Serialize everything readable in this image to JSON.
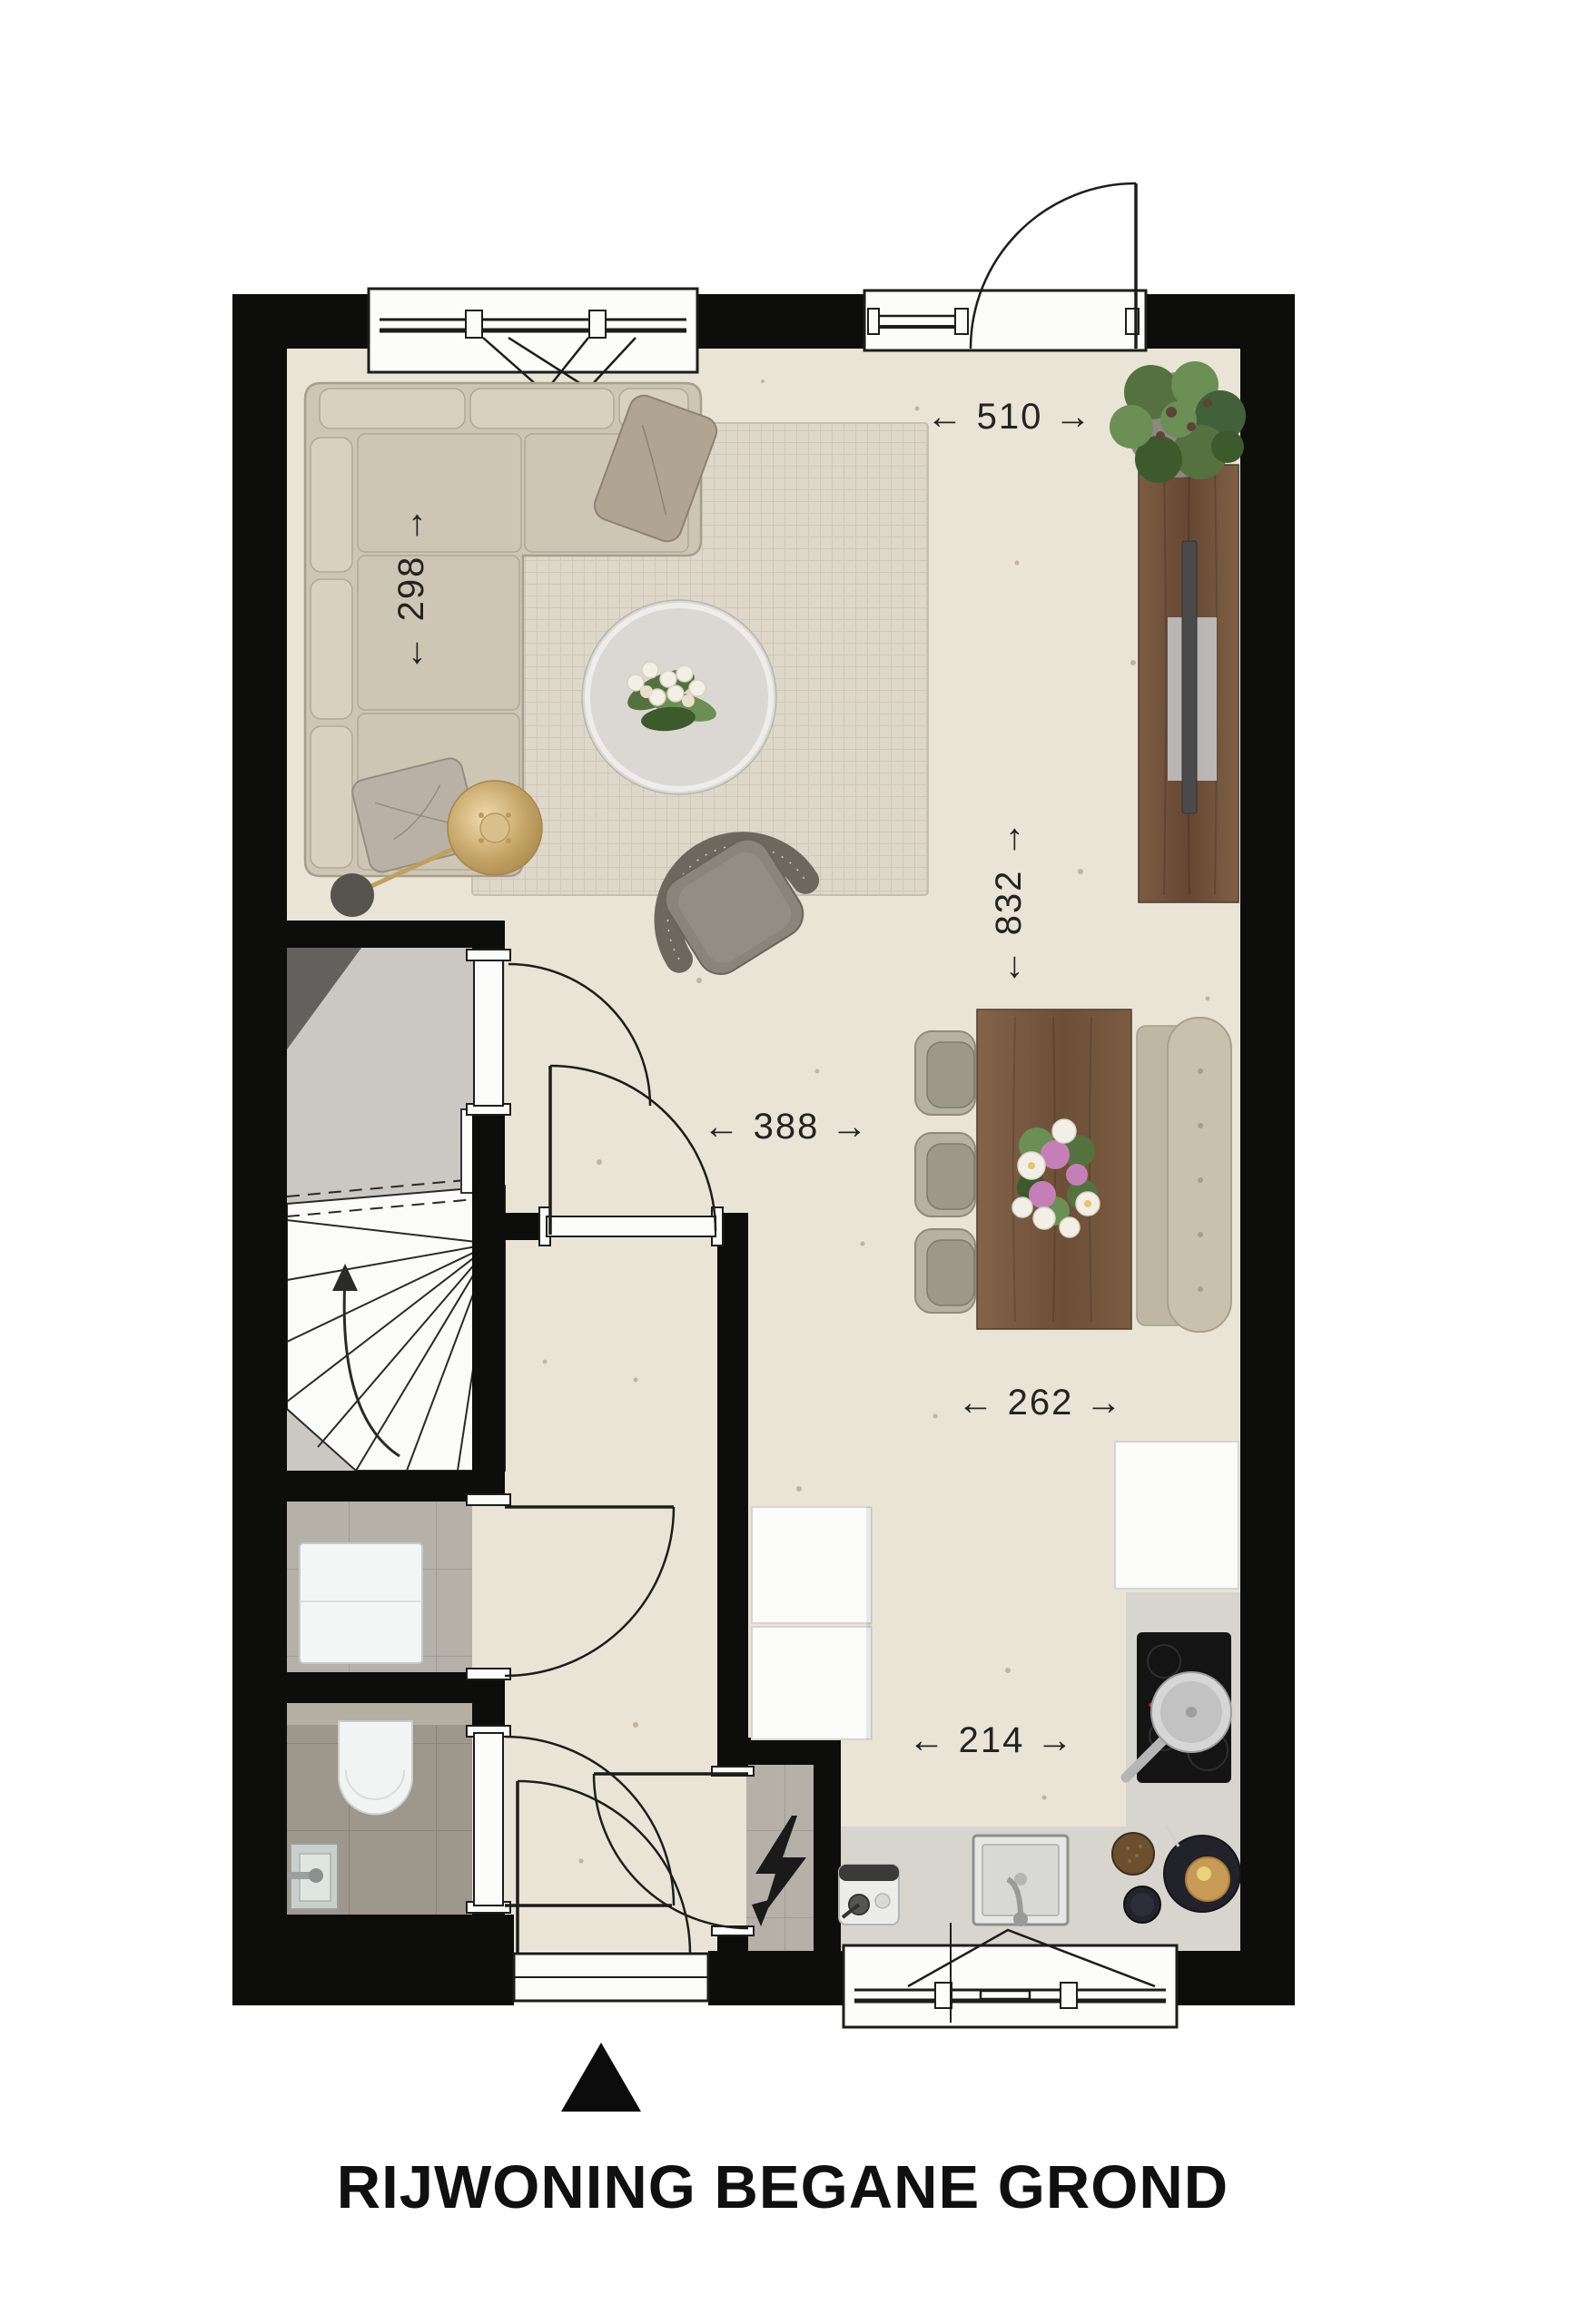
{
  "title": "RIJWONING BEGANE GROND",
  "plan": {
    "dimensions": {
      "entry_width": "← 510 →",
      "sofa_zone_depth": "← 298 →",
      "living_length": "← 832 →",
      "living_width": "← 388 →",
      "dining_width": "← 262 →",
      "kitchen_width": "← 214 →"
    },
    "icons": {
      "electric_meter": "lightning-bolt-icon",
      "entrance_marker": "triangle-up-marker"
    }
  },
  "colors": {
    "wall": "#0d0d0c",
    "line": "#1d1d1b",
    "text": "#232321",
    "white": "#fcfcfb",
    "floorLiving": "#e9e4d6",
    "floorConcrete": "#cbc8c3",
    "floorTile": "#b6b1a8",
    "floorTileDark": "#9d978c",
    "cistern": "#b4aea3",
    "counter": "#d8d5cf",
    "rug": "#ddd8ca",
    "rugLine": "#c6bfae",
    "sofa": "#cdc6b5",
    "sofaCushion": "#d8d1c0",
    "sofaLine": "#a89e8b",
    "pillowDark": "#b0a492",
    "pillowSilver": "#b9b1a6",
    "wood1": "#7c5d43",
    "wood2": "#654733",
    "chair": "#b6b2a3",
    "chairInner": "#9c988a",
    "bench": "#c9c0ae",
    "benchSeat": "#bfb6a4",
    "armchair": "#8b847a",
    "armchairBack": "#6e675e",
    "steel": "#d6d6d4",
    "hob": "#141414",
    "green1": "#55713f",
    "green2": "#3c5a2c",
    "green3": "#6b8f55",
    "brass1": "#e7cf9a",
    "brass2": "#c3a365",
    "pink": "#c57fb8",
    "cream": "#f2efe6",
    "bowl": "#6b4f2e",
    "plate": "#22222a",
    "pancake": "#c79a55",
    "pot": "#8d8880",
    "lampBase": "#57534d",
    "speckle": "#8a6b4f"
  }
}
